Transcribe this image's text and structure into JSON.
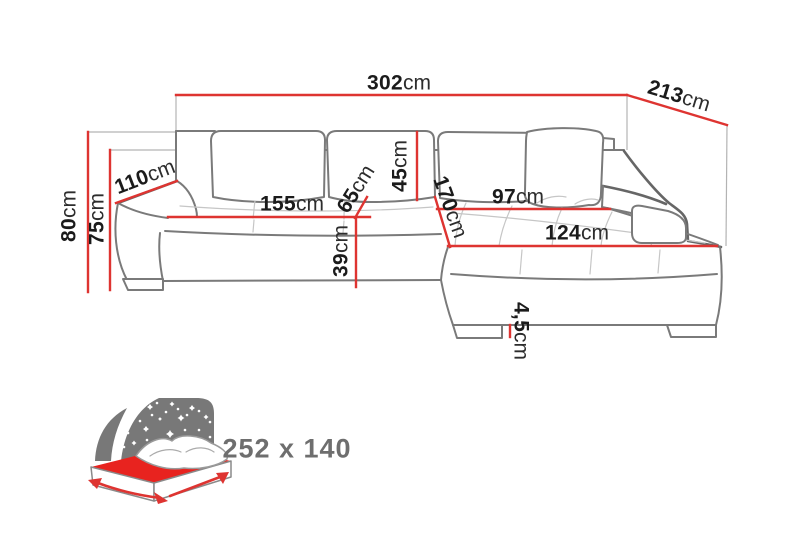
{
  "diagram_type": "corner-sofa-dimension-diagram",
  "colors": {
    "background": "#ffffff",
    "dimension_red": "#de3431",
    "extension_gray": "#b3b3b3",
    "sofa_outline": "#7a7a7a",
    "sofa_outline_dark": "#666666",
    "tuft_gray": "#c6c6c6",
    "icon_gray": "#787878",
    "bed_red": "#e8231f",
    "label_color": "#1b1b1b",
    "sleeping_text": "#6e6e6e"
  },
  "dims": {
    "total_width": {
      "value": "302",
      "unit": "cm"
    },
    "total_depth": {
      "value": "213",
      "unit": "cm"
    },
    "total_height": {
      "value": "80",
      "unit": "cm"
    },
    "back_height": {
      "value": "75",
      "unit": "cm"
    },
    "side_depth": {
      "value": "110",
      "unit": "cm"
    },
    "seat_width": {
      "value": "155",
      "unit": "cm"
    },
    "seat_depth": {
      "value": "65",
      "unit": "cm"
    },
    "back_cushion_height": {
      "value": "45",
      "unit": "cm"
    },
    "seat_height": {
      "value": "39",
      "unit": "cm"
    },
    "chaise_length": {
      "value": "170",
      "unit": "cm"
    },
    "chaise_back_width": {
      "value": "97",
      "unit": "cm"
    },
    "chaise_front_width": {
      "value": "124",
      "unit": "cm"
    },
    "leg_height": {
      "value": "4,5",
      "unit": "cm"
    }
  },
  "sleeping_area": {
    "label": "252 x 140"
  }
}
